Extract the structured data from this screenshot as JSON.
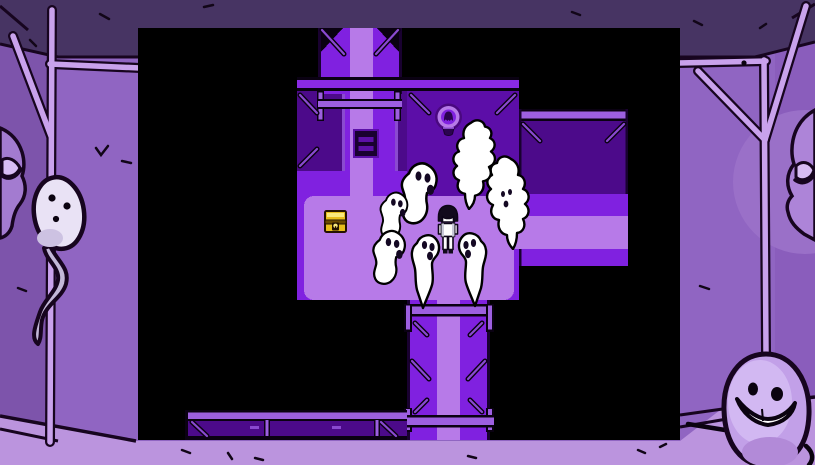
{
  "scene": {
    "kind": "pixel-rpg-room-in-hand-drawn-frame",
    "visible_text": "none"
  },
  "palette": {
    "game_bright": "#8021e0",
    "game_light": "#b77ae8",
    "game_mid_room": "#5c0ea8",
    "game_dark_room": "#4c0a8a",
    "game_beam": "#9d5fe0",
    "game_beam_fill": "#8a2ae4",
    "game_strut": "#8a4ad0",
    "game_outline": "#190130",
    "game_ink": "#0a0112",
    "sprite_ink": "#140823",
    "ghost_white": "#ffffff",
    "chest_yellow": "#e8bd1c",
    "chest_highlight": "#f9e87c",
    "chest_band": "#6b4a00",
    "frame_wall": "#9065c2",
    "frame_wall_left": "#7d54ab",
    "frame_wall_right": "#8a5dbc",
    "frame_ceiling": "#473463",
    "frame_floor": "#bb94de",
    "frame_pole": "#c9a2ec",
    "frame_ink": "#17051f",
    "frame_ghost_body": "#c2a0e8",
    "frame_ghost_light": "#d2b8f2",
    "frame_face": "#a37bd0",
    "frame_eyelid": "#d8bcf4"
  },
  "viewport": {
    "x": 138,
    "y": 28,
    "width": 542,
    "height": 412
  },
  "game": {
    "player": {
      "id": "player-character",
      "x": 297,
      "y": 176,
      "width": 26,
      "height": 52,
      "facing": "down"
    },
    "chest": {
      "id": "treasure-chest",
      "x": 186,
      "y": 181,
      "width": 23,
      "height": 25
    },
    "statue": {
      "id": "ghost-statue",
      "x": 295,
      "y": 75,
      "width": 31,
      "height": 41
    },
    "ghosts": [
      {
        "id": "ghost-1",
        "variant": "profile",
        "facing": "right",
        "x": 258,
        "y": 132,
        "width": 44,
        "height": 68
      },
      {
        "id": "ghost-2",
        "variant": "profile",
        "facing": "right",
        "x": 238,
        "y": 162,
        "width": 34,
        "height": 52
      },
      {
        "id": "ghost-3",
        "variant": "profile",
        "facing": "right",
        "x": 230,
        "y": 200,
        "width": 40,
        "height": 60
      },
      {
        "id": "ghost-4",
        "variant": "drip",
        "facing": "right",
        "x": 270,
        "y": 204,
        "width": 34,
        "height": 80
      },
      {
        "id": "ghost-5",
        "variant": "drip",
        "facing": "left",
        "x": 318,
        "y": 202,
        "width": 34,
        "height": 80
      },
      {
        "id": "ghost-6",
        "variant": "cloud",
        "facing": "left",
        "face": true,
        "x": 346,
        "y": 126,
        "width": 48,
        "height": 96
      },
      {
        "id": "ghost-7",
        "variant": "cloud",
        "facing": "right",
        "face": false,
        "x": 312,
        "y": 90,
        "width": 48,
        "height": 92
      }
    ],
    "ghost_count": 7
  },
  "frame": {
    "left_character": "tadpole-ghost-hanging-on-pole",
    "right_character": "smiling-ghost-hanging-on-pole",
    "left_edge": "peeking-ghost-face",
    "right_edge": "peeking-ghost-face"
  }
}
